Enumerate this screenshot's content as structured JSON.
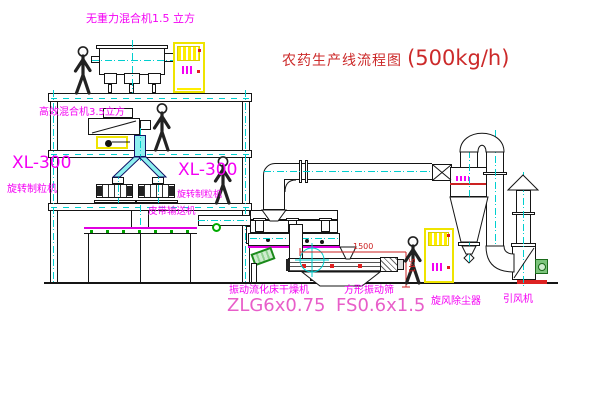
{
  "title": {
    "main": "农药生产线流程图",
    "capacity": "(500kg/h)"
  },
  "labels": {
    "top_mixer": "无重力混合机1.5 立方",
    "floor2_mixer": "高效混合机3.5立方",
    "granulator_left_model": "XL-300",
    "granulator_left_name": "旋转制粒机",
    "granulator_right_model": "XL-300",
    "granulator_right_name": "旋转制粒机",
    "belt_conveyor": "皮带输送机",
    "dryer_name": "振动流化床干燥机",
    "dryer_model": "ZLG6x0.75",
    "sifter_name": "方形振动筛",
    "sifter_model": "FS0.6x1.5",
    "cyclone_name": "旋风除尘器",
    "fan_name": "引风机"
  },
  "dimensions": {
    "sifter_length": "1500",
    "sifter_height": "541"
  },
  "colors": {
    "label_magenta": "#f400f4",
    "model_pink": "#e85ec9",
    "title_red": "#cc2a2a",
    "centerline_cyan": "#00cfcf",
    "cabinet_yellow": "#efe400",
    "motor_green": "#33aa33",
    "accent_red": "#e02020",
    "line_black": "#151515"
  }
}
